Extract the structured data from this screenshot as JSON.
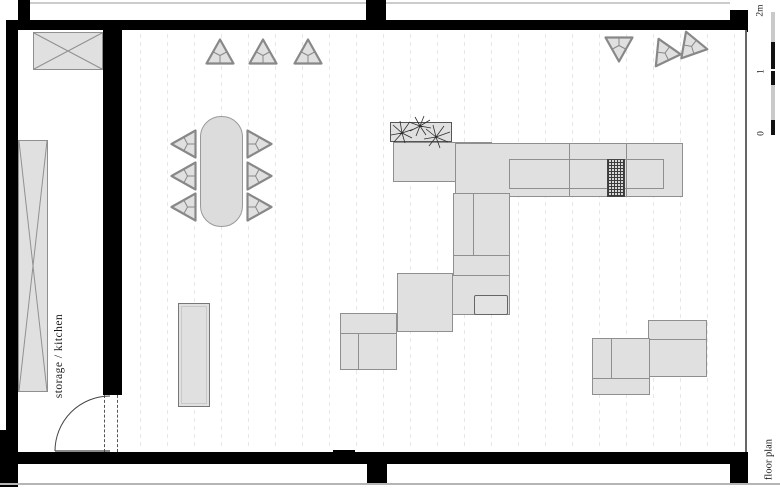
{
  "drawing": {
    "caption": "floor plan",
    "room_label": "storage / kitchen"
  },
  "scale_bar": {
    "top_label": "2m",
    "mid_label": "1",
    "bottom_label": "0"
  },
  "colors": {
    "wall": "#000000",
    "furniture_fill": "#e0e0e0",
    "furniture_border": "#8f8f8f",
    "floorboard_line": "#e7e7e7",
    "hatch_line": "#3c3c3c",
    "ground_line": "#b5b5b5",
    "scale_light": "#c9c9c9",
    "scale_dark": "#111111"
  },
  "elements": {
    "rooms": [
      "main-room",
      "storage-kitchen-room"
    ],
    "furniture": [
      "dining-table",
      "triangular-stools",
      "bench",
      "kitchen-counter-units",
      "planter-box",
      "hatched-appliance",
      "crossed-storage-units",
      "swing-door"
    ]
  }
}
